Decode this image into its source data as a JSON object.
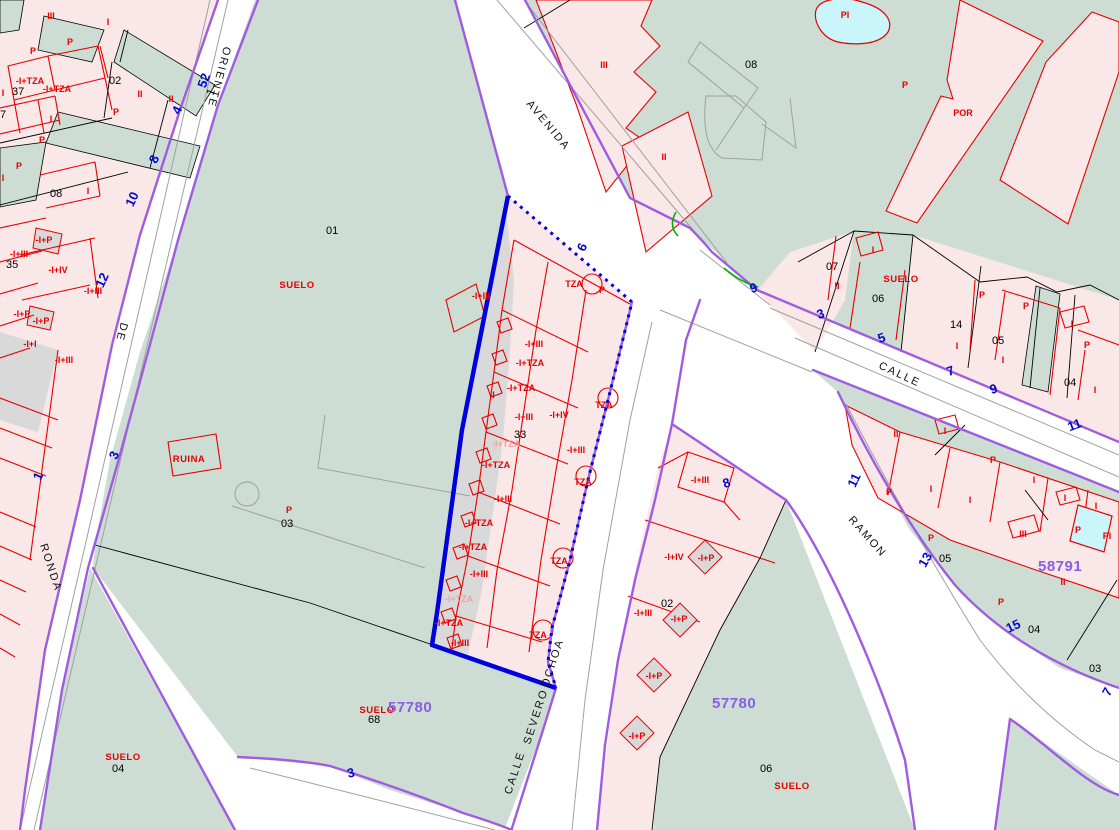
{
  "map": {
    "palette": {
      "land_green": "#cdddd3",
      "built_pink": "#fae7e7",
      "unbuilt_grey": "#d9d9d9",
      "pool_cyan": "#c9f5fb",
      "cadastre_red": "#e60000",
      "boundary_purple": "#a05ce0",
      "selection_blue": "#0000dd",
      "street_number_blue": "#0008cc",
      "sector_purple": "#8a5ce8"
    },
    "street_names": [
      {
        "t": "ORIENTE",
        "x": 224,
        "y": 46,
        "r": 105
      },
      {
        "t": "DE",
        "x": 121,
        "y": 322,
        "r": 105
      },
      {
        "t": "RONDA",
        "x": 40,
        "y": 545,
        "r": 72
      },
      {
        "t": "AVENIDA",
        "x": 526,
        "y": 104,
        "r": 50
      },
      {
        "t": "CALLE",
        "x": 878,
        "y": 368,
        "r": 25
      },
      {
        "t": "RAMON",
        "x": 848,
        "y": 520,
        "r": 48
      },
      {
        "t": "CALLE",
        "x": 511,
        "y": 795,
        "r": -72
      },
      {
        "t": "SEVERO",
        "x": 530,
        "y": 745,
        "r": -72
      },
      {
        "t": "OCHOA",
        "x": 548,
        "y": 688,
        "r": -72
      }
    ],
    "parcel_numbers": [
      {
        "t": "02",
        "x": 109,
        "y": 84
      },
      {
        "t": "37",
        "x": 12,
        "y": 95
      },
      {
        "t": "7",
        "x": 0,
        "y": 118
      },
      {
        "t": "1",
        "x": 213,
        "y": 96,
        "r": -70
      },
      {
        "t": "35",
        "x": 6,
        "y": 268
      },
      {
        "t": "08",
        "x": 50,
        "y": 197
      },
      {
        "t": "08",
        "x": 745,
        "y": 68
      },
      {
        "t": "01",
        "x": 326,
        "y": 234
      },
      {
        "t": "03",
        "x": 281,
        "y": 527
      },
      {
        "t": "33",
        "x": 514,
        "y": 438
      },
      {
        "t": "68",
        "x": 368,
        "y": 723
      },
      {
        "t": "04",
        "x": 112,
        "y": 772
      },
      {
        "t": "02",
        "x": 661,
        "y": 607
      },
      {
        "t": "06",
        "x": 760,
        "y": 772
      },
      {
        "t": "07",
        "x": 826,
        "y": 270
      },
      {
        "t": "06",
        "x": 872,
        "y": 302
      },
      {
        "t": "14",
        "x": 950,
        "y": 328
      },
      {
        "t": "05",
        "x": 992,
        "y": 344
      },
      {
        "t": "04",
        "x": 1064,
        "y": 386
      },
      {
        "t": "05",
        "x": 939,
        "y": 562
      },
      {
        "t": "04",
        "x": 1028,
        "y": 633
      },
      {
        "t": "03",
        "x": 1089,
        "y": 672
      }
    ],
    "height_labels": [
      {
        "t": "III",
        "x": 51,
        "y": 19
      },
      {
        "t": "I",
        "x": 108,
        "y": 25
      },
      {
        "t": "P",
        "x": 70,
        "y": 45
      },
      {
        "t": "P",
        "x": 33,
        "y": 54
      },
      {
        "t": "-I+TZA",
        "x": 30,
        "y": 84
      },
      {
        "t": "-I+TZA",
        "x": 57,
        "y": 92
      },
      {
        "t": "II",
        "x": 140,
        "y": 97
      },
      {
        "t": "II",
        "x": 171,
        "y": 102
      },
      {
        "t": "I",
        "x": 3,
        "y": 96
      },
      {
        "t": "I",
        "x": 51,
        "y": 122
      },
      {
        "t": "P",
        "x": 116,
        "y": 115
      },
      {
        "t": "P",
        "x": 42,
        "y": 143
      },
      {
        "t": "P",
        "x": 19,
        "y": 169
      },
      {
        "t": "I",
        "x": 88,
        "y": 194
      },
      {
        "t": "I",
        "x": 3,
        "y": 181
      },
      {
        "t": "-I+P",
        "x": 44,
        "y": 243
      },
      {
        "t": "-I+III",
        "x": 19,
        "y": 257
      },
      {
        "t": "-I+IV",
        "x": 58,
        "y": 273
      },
      {
        "t": "-I+III",
        "x": 93,
        "y": 294
      },
      {
        "t": "-I+P",
        "x": 22,
        "y": 317
      },
      {
        "t": "-I+P",
        "x": 41,
        "y": 324
      },
      {
        "t": "-I+I",
        "x": 30,
        "y": 347
      },
      {
        "t": "-I+III",
        "x": 64,
        "y": 363
      },
      {
        "t": "-I+III",
        "x": 481,
        "y": 299
      },
      {
        "t": "TZA",
        "x": 574,
        "y": 287
      },
      {
        "t": "P",
        "x": 602,
        "y": 293
      },
      {
        "t": "-I+III",
        "x": 534,
        "y": 347
      },
      {
        "t": "-I+TZA",
        "x": 530,
        "y": 366
      },
      {
        "t": "-I+TZA",
        "x": 521,
        "y": 391
      },
      {
        "t": "-I",
        "x": 492,
        "y": 398
      },
      {
        "t": "-I+IV",
        "x": 559,
        "y": 418
      },
      {
        "t": "-I+III",
        "x": 524,
        "y": 420
      },
      {
        "t": "-I+TZA",
        "x": 506,
        "y": 447,
        "light": true
      },
      {
        "t": "TZA",
        "x": 604,
        "y": 408
      },
      {
        "t": "-I+TZA",
        "x": 496,
        "y": 468
      },
      {
        "t": "-I+III",
        "x": 576,
        "y": 453
      },
      {
        "t": "TZA",
        "x": 583,
        "y": 485
      },
      {
        "t": "-I+III",
        "x": 503,
        "y": 502
      },
      {
        "t": "-I+TZA",
        "x": 479,
        "y": 526
      },
      {
        "t": "-I+TZA",
        "x": 473,
        "y": 550
      },
      {
        "t": "-I+III",
        "x": 479,
        "y": 577
      },
      {
        "t": "-I+TZA",
        "x": 459,
        "y": 602,
        "light": true
      },
      {
        "t": "TZA",
        "x": 559,
        "y": 564
      },
      {
        "t": "-I+TZA",
        "x": 449,
        "y": 626
      },
      {
        "t": "-I+III",
        "x": 460,
        "y": 646
      },
      {
        "t": "TZA",
        "x": 538,
        "y": 638
      },
      {
        "t": "-I+III",
        "x": 700,
        "y": 483
      },
      {
        "t": "-I+IV",
        "x": 674,
        "y": 560
      },
      {
        "t": "-I+P",
        "x": 706,
        "y": 561
      },
      {
        "t": "-I+III",
        "x": 643,
        "y": 616
      },
      {
        "t": "-I+P",
        "x": 679,
        "y": 622
      },
      {
        "t": "-I+P",
        "x": 654,
        "y": 679
      },
      {
        "t": "-I+P",
        "x": 637,
        "y": 739
      },
      {
        "t": "III",
        "x": 604,
        "y": 68
      },
      {
        "t": "II",
        "x": 664,
        "y": 160
      },
      {
        "t": "P",
        "x": 905,
        "y": 88
      },
      {
        "t": "POR",
        "x": 963,
        "y": 116
      },
      {
        "t": "PI",
        "x": 845,
        "y": 18
      },
      {
        "t": "II",
        "x": 837,
        "y": 289
      },
      {
        "t": "I",
        "x": 873,
        "y": 253
      },
      {
        "t": "P",
        "x": 982,
        "y": 298
      },
      {
        "t": "I",
        "x": 957,
        "y": 349
      },
      {
        "t": "P",
        "x": 1026,
        "y": 309
      },
      {
        "t": "I",
        "x": 1072,
        "y": 327
      },
      {
        "t": "P",
        "x": 1087,
        "y": 348
      },
      {
        "t": "I",
        "x": 1003,
        "y": 363
      },
      {
        "t": "I",
        "x": 1095,
        "y": 393
      },
      {
        "t": "II",
        "x": 896,
        "y": 437
      },
      {
        "t": "I",
        "x": 945,
        "y": 434
      },
      {
        "t": "P",
        "x": 889,
        "y": 495
      },
      {
        "t": "I",
        "x": 931,
        "y": 492
      },
      {
        "t": "I",
        "x": 970,
        "y": 503
      },
      {
        "t": "P",
        "x": 993,
        "y": 463
      },
      {
        "t": "I",
        "x": 1034,
        "y": 483
      },
      {
        "t": "I",
        "x": 1065,
        "y": 501
      },
      {
        "t": "I",
        "x": 1096,
        "y": 509
      },
      {
        "t": "III",
        "x": 1023,
        "y": 537
      },
      {
        "t": "P",
        "x": 1078,
        "y": 533
      },
      {
        "t": "P",
        "x": 931,
        "y": 541
      },
      {
        "t": "P",
        "x": 1001,
        "y": 605
      },
      {
        "t": "II",
        "x": 1063,
        "y": 585
      },
      {
        "t": "PI",
        "x": 1107,
        "y": 539
      },
      {
        "t": "P",
        "x": 289,
        "y": 513
      }
    ],
    "land_labels": [
      {
        "t": "SUELO",
        "x": 297,
        "y": 288
      },
      {
        "t": "SUELO",
        "x": 123,
        "y": 760
      },
      {
        "t": "SUELO",
        "x": 377,
        "y": 713
      },
      {
        "t": "SUELO",
        "x": 792,
        "y": 789
      },
      {
        "t": "SUELO",
        "x": 901,
        "y": 282
      },
      {
        "t": "RUINA",
        "x": 189,
        "y": 462
      }
    ],
    "street_numbers": [
      {
        "t": "52",
        "x": 208,
        "y": 82,
        "r": -70
      },
      {
        "t": "4",
        "x": 181,
        "y": 112,
        "r": -65
      },
      {
        "t": "8",
        "x": 158,
        "y": 161,
        "r": -65
      },
      {
        "t": "10",
        "x": 136,
        "y": 201,
        "r": -65
      },
      {
        "t": "12",
        "x": 106,
        "y": 282,
        "r": -65
      },
      {
        "t": "1",
        "x": 42,
        "y": 478,
        "r": -65
      },
      {
        "t": "3",
        "x": 118,
        "y": 457,
        "r": -65
      },
      {
        "t": "3",
        "x": 352,
        "y": 777,
        "r": -15
      },
      {
        "t": "6",
        "x": 586,
        "y": 249,
        "r": -65
      },
      {
        "t": "9",
        "x": 755,
        "y": 292,
        "r": -20
      },
      {
        "t": "3",
        "x": 822,
        "y": 318,
        "r": -20
      },
      {
        "t": "5",
        "x": 883,
        "y": 342,
        "r": -20
      },
      {
        "t": "7",
        "x": 952,
        "y": 375,
        "r": -20
      },
      {
        "t": "9",
        "x": 995,
        "y": 393,
        "r": -20
      },
      {
        "t": "11",
        "x": 1076,
        "y": 429,
        "r": -20
      },
      {
        "t": "11",
        "x": 858,
        "y": 482,
        "r": -65
      },
      {
        "t": "8",
        "x": 728,
        "y": 487,
        "r": -20
      },
      {
        "t": "13",
        "x": 929,
        "y": 562,
        "r": -60
      },
      {
        "t": "15",
        "x": 1015,
        "y": 630,
        "r": -25
      },
      {
        "t": "7",
        "x": 1111,
        "y": 694,
        "r": -60
      }
    ],
    "sector_numbers": [
      {
        "t": "57780",
        "x": 388,
        "y": 712
      },
      {
        "t": "57780",
        "x": 712,
        "y": 708
      },
      {
        "t": "58791",
        "x": 1038,
        "y": 571
      }
    ]
  }
}
